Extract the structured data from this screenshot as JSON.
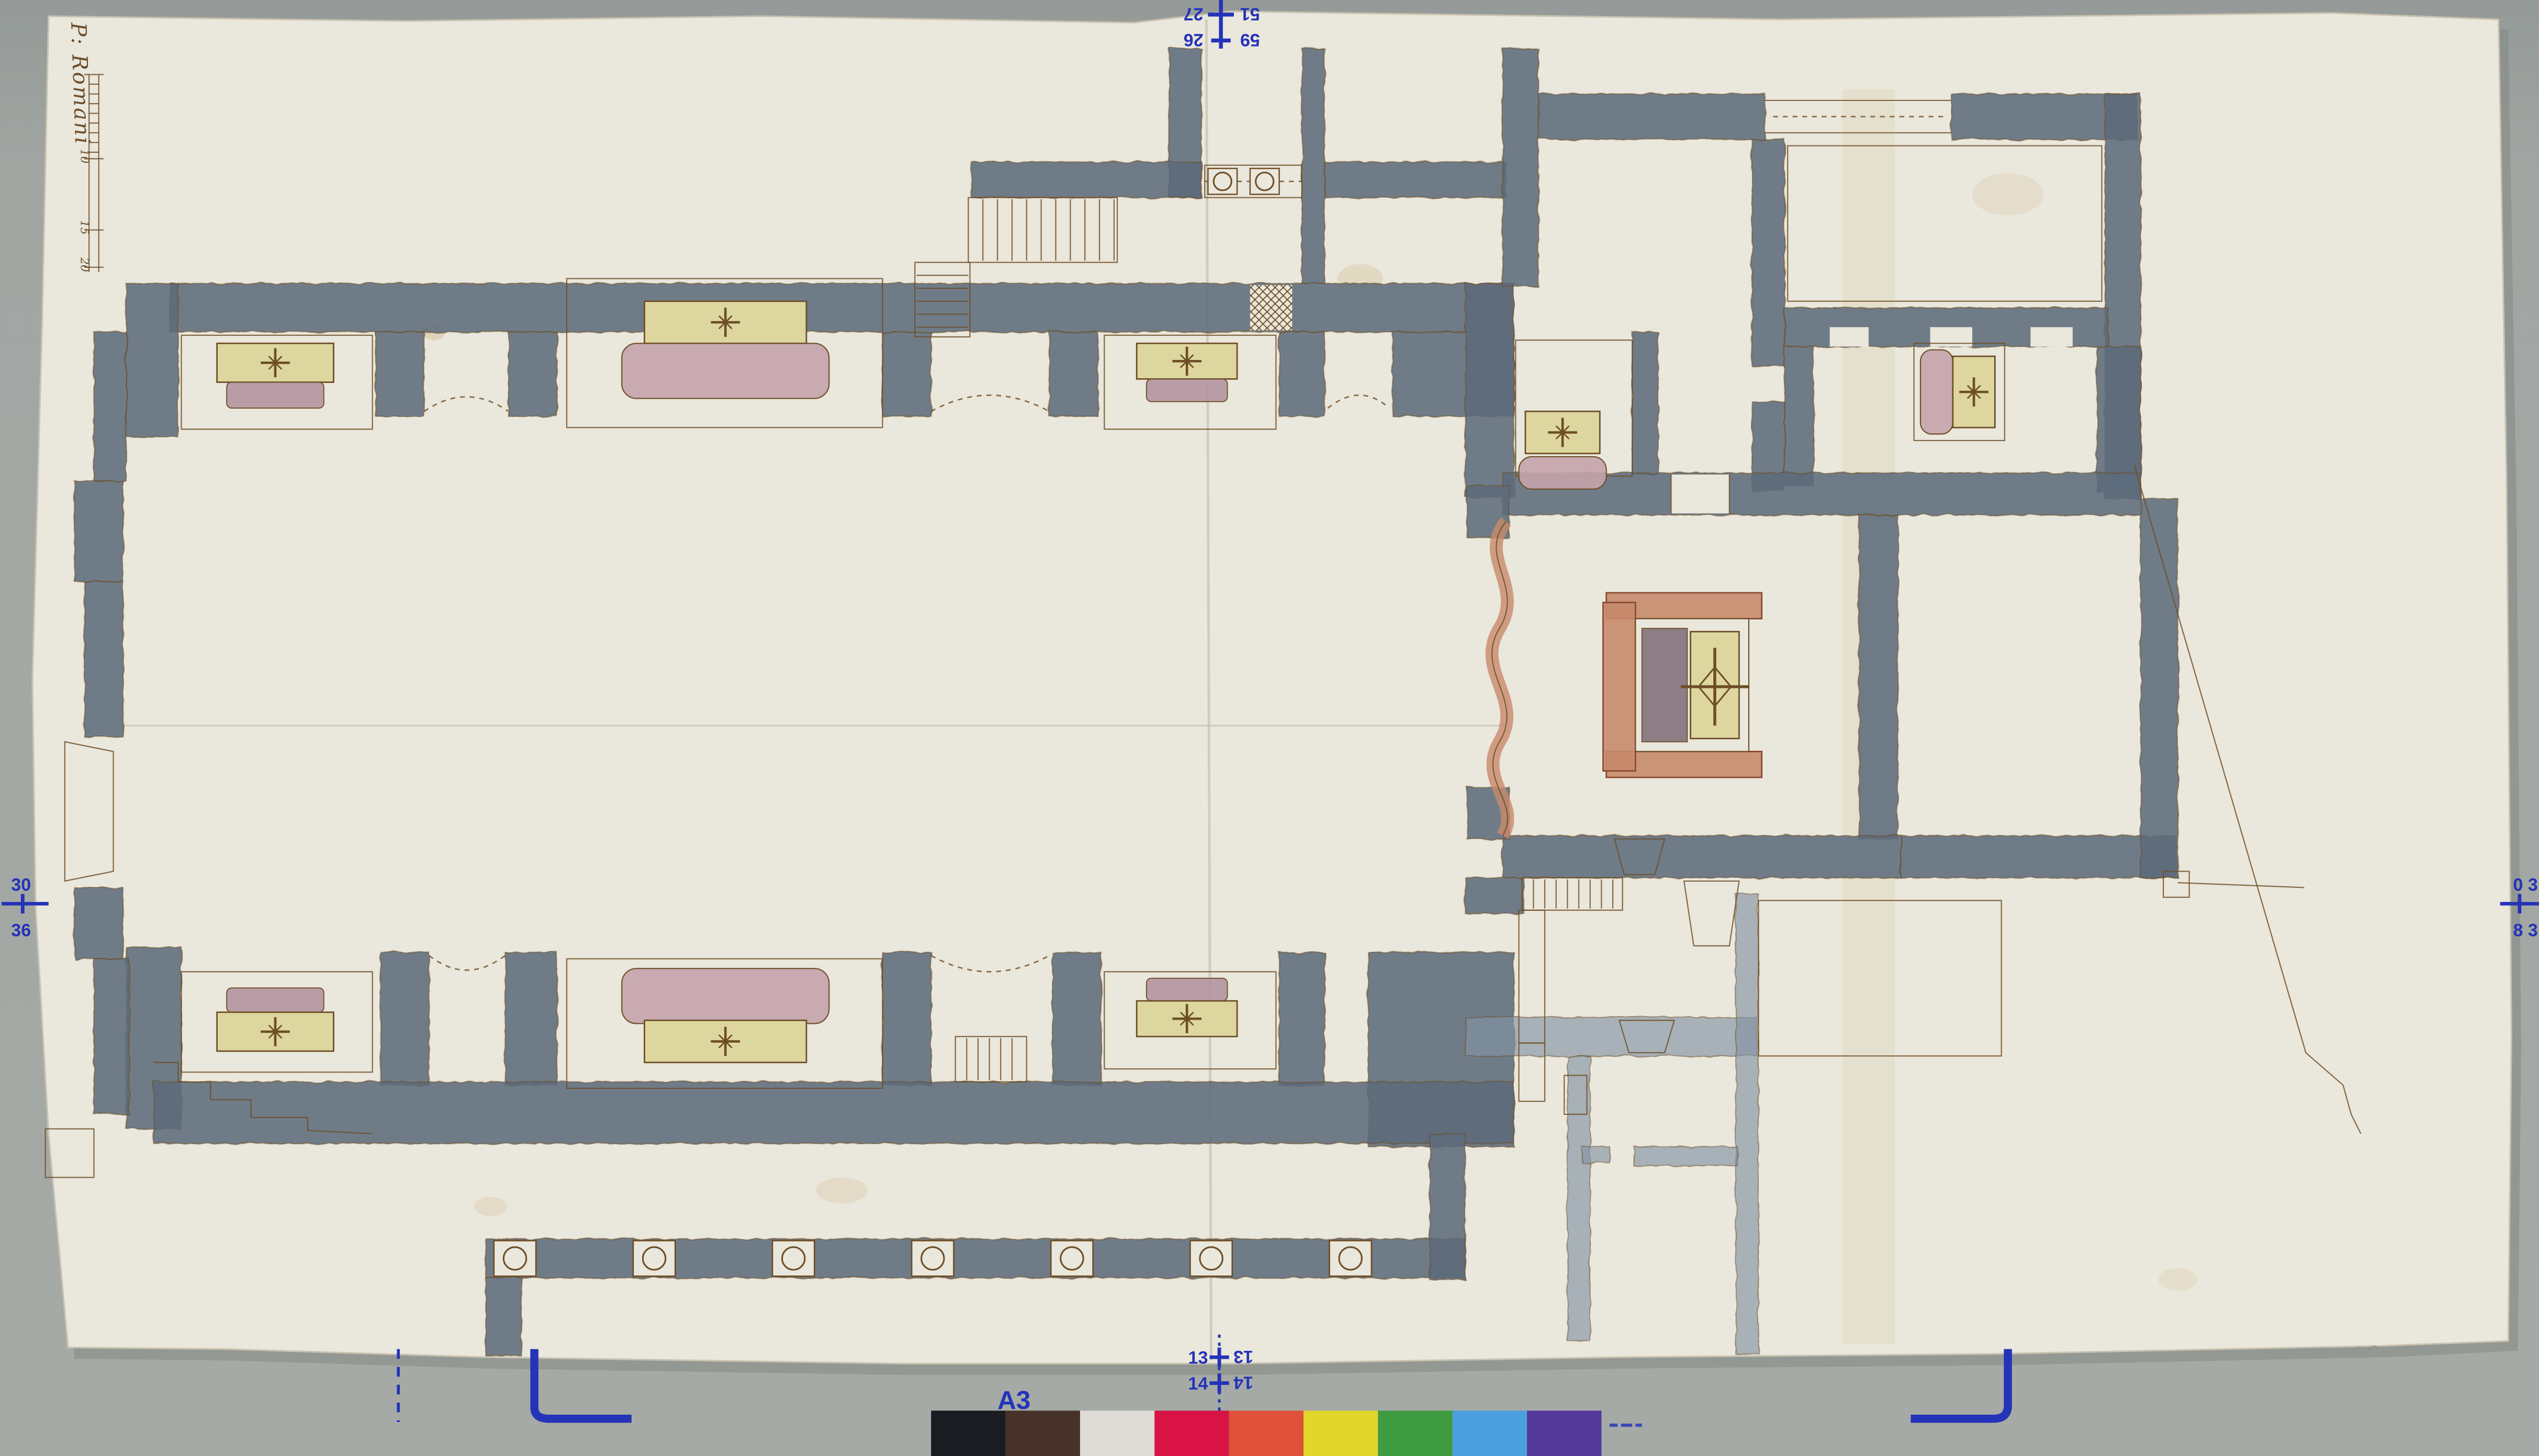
{
  "backdrop": {
    "color": "#a2a6a3",
    "color_top": "#959b98"
  },
  "sheet": {
    "paper_color": "#eae7dc",
    "shadow_color": "#848884",
    "stain_color": "#c7a96a"
  },
  "inscription": {
    "text": "P: Romani"
  },
  "scale_bar": {
    "tick_labels": [
      "10",
      "15",
      "20"
    ]
  },
  "registration": {
    "ink_color": "#2433b8",
    "top_mark": {
      "row1_left": "27",
      "row1_right": "51",
      "row2_left": "26",
      "row2_right": "59"
    },
    "left_mark": {
      "top": "30",
      "bottom": "36"
    },
    "right_mark": {
      "top": "0 3",
      "bottom": "8 3"
    },
    "bottom_mark": {
      "row1_left": "13",
      "row1_right": "13",
      "row2_left": "14",
      "row2_right": "14"
    },
    "sheet_label": "A3"
  },
  "color_bar": {
    "patches": [
      {
        "name": "black",
        "hex": "#1a1c21"
      },
      {
        "name": "dark-brown",
        "hex": "#463228"
      },
      {
        "name": "white",
        "hex": "#dedbd6"
      },
      {
        "name": "crimson",
        "hex": "#d91346"
      },
      {
        "name": "vermilion",
        "hex": "#df5138"
      },
      {
        "name": "yellow",
        "hex": "#e2d52b"
      },
      {
        "name": "green",
        "hex": "#3f9b40"
      },
      {
        "name": "light-blue",
        "hex": "#4aa0de"
      },
      {
        "name": "purple",
        "hex": "#55399a"
      }
    ]
  },
  "plan": {
    "colors": {
      "wall": "#5d6c7c",
      "wall_light": "#8493a3",
      "ink": "#6e4e26",
      "altar_yellow": "#ddd79f",
      "altar_mauve": "#b294a0",
      "altar_pink": "#c4a3ab",
      "altar_salmon": "#c8896c",
      "altar_slab": "#8d7d85"
    },
    "features": [
      "nave",
      "side-chapel",
      "altar",
      "main-altar",
      "right-chapel",
      "sacristy-wing",
      "staircase",
      "colonnade",
      "entrance",
      "boundary-line",
      "scale-bar"
    ]
  }
}
